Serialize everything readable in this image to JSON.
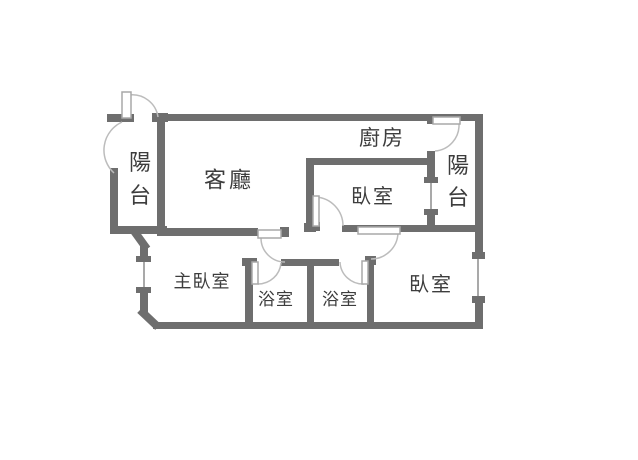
{
  "title": "apartment-floorplan",
  "colors": {
    "background": "#ffffff",
    "wall": "#6e6e6e",
    "door_leaf_fill": "#ffffff",
    "door_leaf_stroke": "#a8a8a8",
    "door_arc": "#bcbcbc",
    "window_line": "#8c8c8c",
    "text": "#3d3d3d"
  },
  "floorplan": {
    "labels": [
      {
        "name": "label-balcony-left",
        "text": "陽台",
        "x": 140,
        "y": 163,
        "size": 22,
        "vertical": true,
        "line_step": 33
      },
      {
        "name": "label-living-room",
        "text": "客廳",
        "x": 229,
        "y": 181,
        "size": 22,
        "vertical": false,
        "spacing": 3
      },
      {
        "name": "label-kitchen",
        "text": "廚房",
        "x": 382,
        "y": 138,
        "size": 21,
        "vertical": false,
        "spacing": 2
      },
      {
        "name": "label-bedroom-top",
        "text": "臥室",
        "x": 373,
        "y": 196,
        "size": 20,
        "vertical": false,
        "spacing": 2
      },
      {
        "name": "label-balcony-right",
        "text": "陽台",
        "x": 458,
        "y": 166,
        "size": 22,
        "vertical": true,
        "line_step": 32
      },
      {
        "name": "label-master-bedroom",
        "text": "主臥室",
        "x": 202,
        "y": 282,
        "size": 18,
        "vertical": false,
        "spacing": 1
      },
      {
        "name": "label-bathroom-1",
        "text": "浴室",
        "x": 276,
        "y": 300,
        "size": 17,
        "vertical": false,
        "spacing": 1
      },
      {
        "name": "label-bathroom-2",
        "text": "浴室",
        "x": 340,
        "y": 300,
        "size": 17,
        "vertical": false,
        "spacing": 1
      },
      {
        "name": "label-bedroom-right",
        "text": "臥室",
        "x": 431,
        "y": 284,
        "size": 20,
        "vertical": false,
        "spacing": 2
      }
    ],
    "walls": [
      {
        "name": "wall-top",
        "x": 157,
        "y": 114,
        "w": 325,
        "h": 7
      },
      {
        "name": "wall-right-upper",
        "x": 475,
        "y": 114,
        "w": 8,
        "h": 138
      },
      {
        "name": "wall-right-lower",
        "x": 475,
        "y": 301,
        "w": 8,
        "h": 28
      },
      {
        "name": "wall-bottom",
        "x": 153,
        "y": 322,
        "w": 330,
        "h": 7
      },
      {
        "name": "wall-balcony-left",
        "x": 110,
        "y": 168,
        "w": 8,
        "h": 65
      },
      {
        "name": "wall-balcony-left-top-cap",
        "x": 107,
        "y": 114,
        "w": 11,
        "h": 8
      },
      {
        "name": "wall-balcony-hinge-cap",
        "x": 117,
        "y": 114,
        "w": 17,
        "h": 8
      },
      {
        "name": "wall-balcony-bottom",
        "x": 110,
        "y": 226,
        "w": 57,
        "h": 8
      },
      {
        "name": "wall-divider-living",
        "x": 157,
        "y": 121,
        "w": 8,
        "h": 112
      },
      {
        "name": "wall-divider-top-cap",
        "x": 152,
        "y": 113,
        "w": 16,
        "h": 9
      },
      {
        "name": "wall-master-top",
        "x": 157,
        "y": 228,
        "w": 101,
        "h": 8
      },
      {
        "name": "wall-master-door-end-cap",
        "x": 280,
        "y": 227,
        "w": 9,
        "h": 10
      },
      {
        "name": "wall-master-left-upper",
        "x": 140,
        "y": 246,
        "w": 8,
        "h": 13
      },
      {
        "name": "wall-master-left-lower",
        "x": 140,
        "y": 291,
        "w": 8,
        "h": 22
      },
      {
        "name": "wall-kitchen-bedroom",
        "x": 307,
        "y": 158,
        "w": 126,
        "h": 7
      },
      {
        "name": "wall-bedroom1-left",
        "x": 306,
        "y": 158,
        "w": 8,
        "h": 71
      },
      {
        "name": "wall-bedroom1-corner",
        "x": 304,
        "y": 223,
        "w": 12,
        "h": 9
      },
      {
        "name": "wall-bedroom1-hinge",
        "x": 309,
        "y": 222,
        "w": 11,
        "h": 9
      },
      {
        "name": "wall-bedrooms-bottom",
        "x": 342,
        "y": 225,
        "w": 136,
        "h": 7
      },
      {
        "name": "wall-corridor-bath-top",
        "x": 281,
        "y": 259,
        "w": 58,
        "h": 7
      },
      {
        "name": "wall-bath1-left",
        "x": 245,
        "y": 259,
        "w": 8,
        "h": 66
      },
      {
        "name": "wall-bath1-top-cap",
        "x": 242,
        "y": 258,
        "w": 15,
        "h": 8
      },
      {
        "name": "wall-bath2-left",
        "x": 307,
        "y": 262,
        "w": 7,
        "h": 60
      },
      {
        "name": "wall-bath2-right",
        "x": 367,
        "y": 259,
        "w": 7,
        "h": 63
      },
      {
        "name": "wall-bath2-right-top-cap",
        "x": 365,
        "y": 256,
        "w": 11,
        "h": 9
      },
      {
        "name": "wall-kitchen-balcony-nub",
        "x": 427,
        "y": 116,
        "w": 8,
        "h": 8
      },
      {
        "name": "wall-kitchen-balcony-mid",
        "x": 427,
        "y": 151,
        "w": 8,
        "h": 28
      },
      {
        "name": "wall-kitchen-balcony-lower",
        "x": 427,
        "y": 214,
        "w": 8,
        "h": 18
      }
    ],
    "diagonals": [
      {
        "name": "diagonal-balcony-to-master",
        "x1": 134,
        "y1": 231,
        "x2": 147,
        "y2": 249
      },
      {
        "name": "diagonal-master-to-bottom",
        "x1": 140,
        "y1": 310,
        "x2": 158,
        "y2": 327
      }
    ],
    "windows": [
      {
        "name": "window-master-left",
        "caps": [
          {
            "x": 136,
            "y": 256,
            "w": 15,
            "h": 6
          },
          {
            "x": 136,
            "y": 287,
            "w": 15,
            "h": 6
          }
        ],
        "line": {
          "x1": 144,
          "y1": 262,
          "x2": 144,
          "y2": 287
        }
      },
      {
        "name": "window-bedroom1-balcony",
        "caps": [
          {
            "x": 424,
            "y": 177,
            "w": 14,
            "h": 6
          },
          {
            "x": 424,
            "y": 209,
            "w": 14,
            "h": 6
          }
        ],
        "line": {
          "x1": 431,
          "y1": 183,
          "x2": 431,
          "y2": 209
        }
      },
      {
        "name": "window-bedroom2-right",
        "caps": [
          {
            "x": 472,
            "y": 252,
            "w": 13,
            "h": 7
          },
          {
            "x": 472,
            "y": 296,
            "w": 13,
            "h": 7
          }
        ],
        "line": {
          "x1": 478,
          "y1": 259,
          "x2": 478,
          "y2": 296
        }
      }
    ],
    "doors": [
      {
        "name": "door-balcony-left",
        "leaf": {
          "x": 122,
          "y": 92,
          "w": 9,
          "h": 26
        },
        "arcs": [
          "M129,95 A26,26 0 0 1 158,117",
          "M122,122 A31,31 0 0 0 114,173"
        ]
      },
      {
        "name": "door-kitchen-balcony",
        "leaf": {
          "x": 433,
          "y": 117,
          "w": 27,
          "h": 7
        },
        "arcs": [
          "M459,124 A26,26 0 0 1 435,151"
        ]
      },
      {
        "name": "door-living-vestibule",
        "leaf": {
          "x": 258,
          "y": 230,
          "w": 23,
          "h": 8
        },
        "arcs": [
          "M261,238 A24,24 0 0 0 285,262"
        ]
      },
      {
        "name": "door-bedroom1",
        "leaf": {
          "x": 313,
          "y": 196,
          "w": 6,
          "h": 30
        },
        "arcs": [
          "M316,197 A29,29 0 0 1 343,226"
        ]
      },
      {
        "name": "door-bedroom2",
        "leaf": {
          "x": 358,
          "y": 227,
          "w": 42,
          "h": 7
        },
        "arcs": [
          "M398,233 A27,27 0 0 1 371,259"
        ]
      },
      {
        "name": "door-bathroom-1",
        "leaf": {
          "x": 252,
          "y": 262,
          "w": 6,
          "h": 22
        },
        "arcs": [
          "M258,284 A23,23 0 0 0 281,263"
        ]
      },
      {
        "name": "door-bathroom-2",
        "leaf": {
          "x": 362,
          "y": 261,
          "w": 6,
          "h": 23
        },
        "arcs": [
          "M364,284 A23,23 0 0 1 340,262"
        ]
      }
    ]
  }
}
